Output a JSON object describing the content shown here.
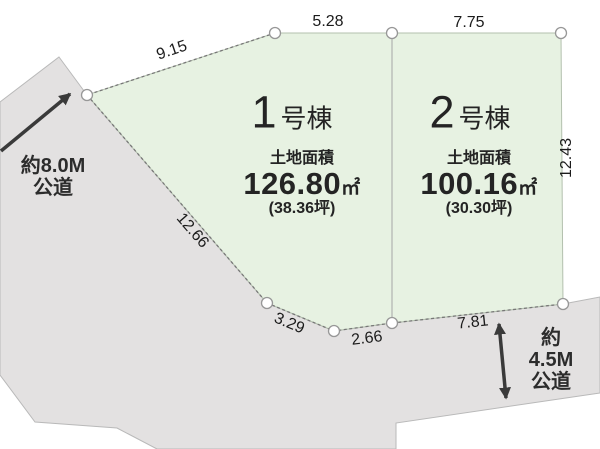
{
  "lots": [
    {
      "name_number": "1",
      "name_suffix": "号棟",
      "area_label": "土地面積",
      "area_value": "126.80",
      "area_unit": "㎡",
      "area_tsubo": "(38.36坪)"
    },
    {
      "name_number": "2",
      "name_suffix": "号棟",
      "area_label": "土地面積",
      "area_value": "100.16",
      "area_unit": "㎡",
      "area_tsubo": "(30.30坪)"
    }
  ],
  "dimensions": {
    "top_left_edge": "9.15",
    "lot1_top_edge": "5.28",
    "lot2_top_edge": "7.75",
    "lot2_right_edge": "12.43",
    "lot1_left_edge": "12.66",
    "lot1_bottom_left_edge": "3.29",
    "lot1_bottom_edge": "2.66",
    "lot2_bottom_edge": "7.81"
  },
  "roads": {
    "west": {
      "width_label": "約8.0M",
      "type_label": "公道"
    },
    "south": {
      "width_label": "約4.5M",
      "type_label": "公道"
    }
  },
  "colors": {
    "lot_fill": "#e7f2e2",
    "road_fill": "#e3e1e1",
    "boundary_line": "#777777",
    "outline": "#b9b9b9",
    "text": "#222222",
    "arrow": "#3a3a3a"
  }
}
